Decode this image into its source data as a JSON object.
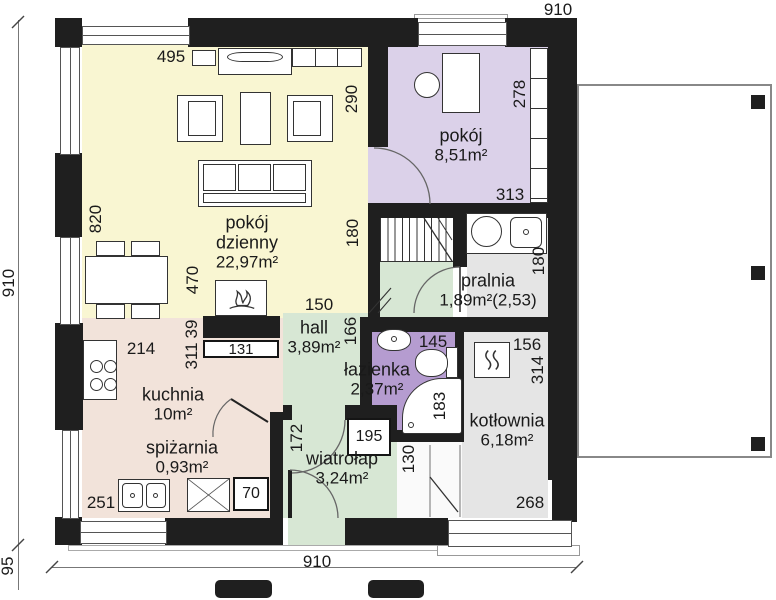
{
  "plan_type": "house floor plan (Polish labels)",
  "colors": {
    "wall": "#1f1f1f",
    "living_fill": "#f9f6d2",
    "bedroom_fill": "#dbd1e9",
    "bathroom_fill": "#b59cd0",
    "green_fill": "#d7e7d4",
    "kitchen_fill": "#f2e3da",
    "utility_fill": "#e5e5e5",
    "line": "#555555"
  },
  "rooms": {
    "living": {
      "name": "pokój dzienny",
      "area": "22,97m²"
    },
    "bedroom": {
      "name": "pokój",
      "area": "8,51m²"
    },
    "laundry": {
      "name": "pralnia",
      "area": "1,89m²(2,53)"
    },
    "hall": {
      "name": "hall",
      "area": "3,89m²"
    },
    "bathroom": {
      "name": "łazienka",
      "area": "2,37m²"
    },
    "kitchen": {
      "name": "kuchnia",
      "area": "10m²"
    },
    "pantry": {
      "name": "spiżarnia",
      "area": "0,93m²"
    },
    "vestibule": {
      "name": "wiatrołap",
      "area": "3,24m²"
    },
    "boiler": {
      "name": "kotłownia",
      "area": "6,18m²"
    }
  },
  "dims": {
    "top": "910",
    "left": "910",
    "left_offset": "95",
    "bottom": "910",
    "d495": "495",
    "d290": "290",
    "d820": "820",
    "d278": "278",
    "d313": "313",
    "d180_stairs": "180",
    "d180_laundry": "180",
    "d470": "470",
    "d150": "150",
    "d166": "166",
    "d39": "39",
    "d311": "311",
    "d214": "214",
    "d131": "131",
    "d145": "145",
    "d156": "156",
    "d314": "314",
    "d183": "183",
    "d172": "172",
    "d195": "195",
    "d130": "130",
    "d251": "251",
    "d70": "70",
    "d268": "268"
  }
}
